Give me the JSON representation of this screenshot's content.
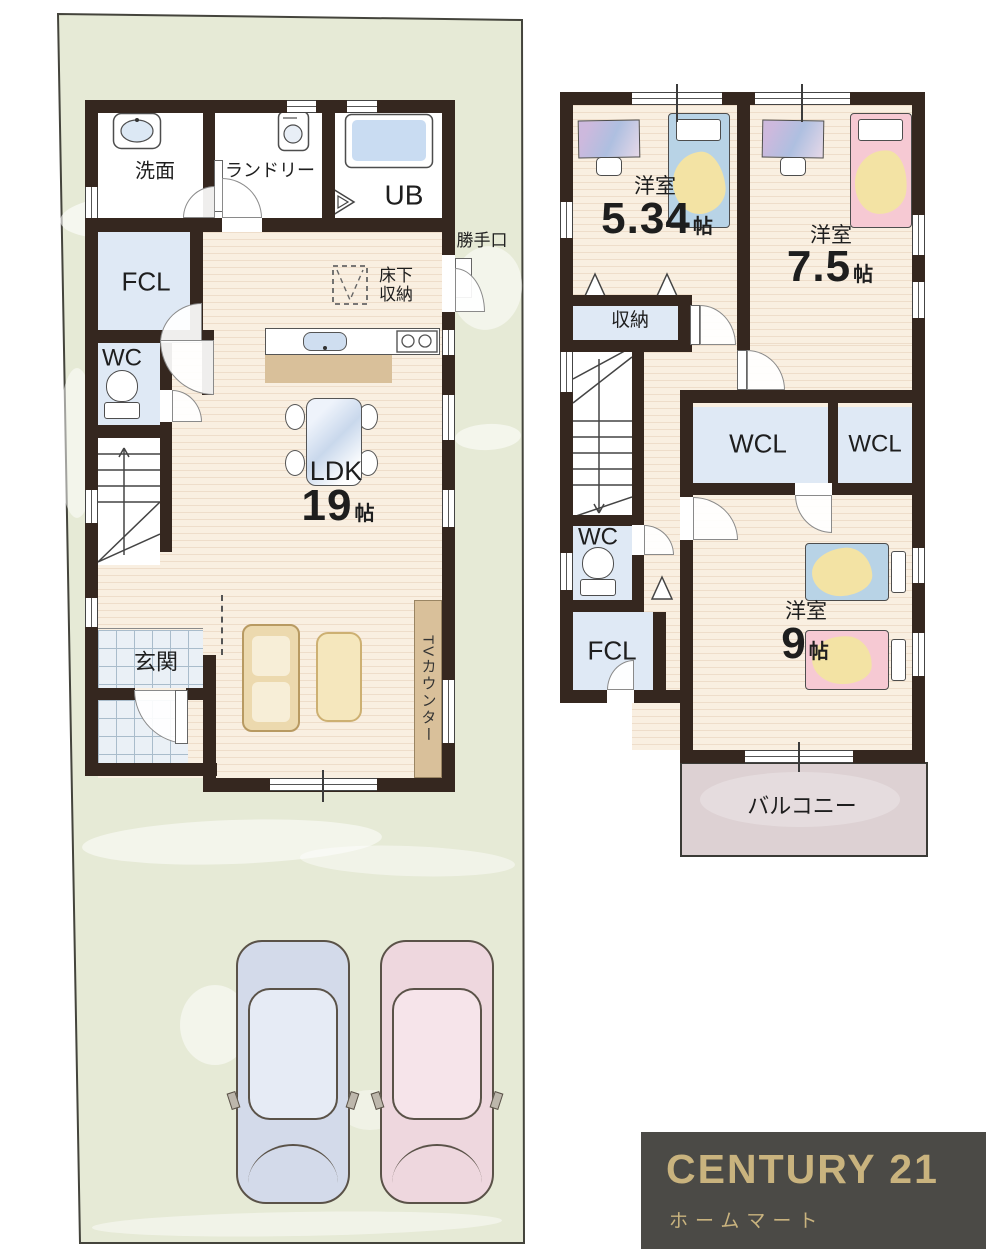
{
  "floor1": {
    "rooms": {
      "senmen": "洗面",
      "laundry": "ランドリー",
      "ub": "UB",
      "fcl": "FCL",
      "wc": "WC",
      "genkan": "玄関",
      "ldk": {
        "name": "LDK",
        "size": "19",
        "unit": "帖"
      }
    },
    "annotations": {
      "katteguchi": "勝手口",
      "yukashita_line1": "床下",
      "yukashita_line2": "収納",
      "tv_counter": "TVカウンター"
    }
  },
  "floor2": {
    "rooms": {
      "bed1": {
        "name": "洋室",
        "size": "5.34",
        "unit": "帖"
      },
      "bed2": {
        "name": "洋室",
        "size": "7.5",
        "unit": "帖"
      },
      "bed3": {
        "name": "洋室",
        "size": "9",
        "unit": "帖"
      },
      "shuno": "収納",
      "wcl_left": "WCL",
      "wcl_right": "WCL",
      "wc": "WC",
      "fcl": "FCL",
      "balcony": "バルコニー"
    }
  },
  "logo": {
    "brand": "CENTURY 21",
    "subtitle": "ホームマート"
  },
  "colors": {
    "wall": "#35271f",
    "lot_green": "#e6ead6",
    "wood_floor": "#f9efe1",
    "room_blue": "#dfe9f5",
    "balcony_pink": "#ddd1d3",
    "counter_tan": "#d9c09a",
    "logo_bg": "#4b4a46",
    "logo_gold": "#c9b37e",
    "bed_blue": "#b8d3e6",
    "bed_pink": "#f6c9d3",
    "blanket_yellow": "#f3e3a4",
    "car_blue": "#d3daea",
    "car_pink": "#eed7de"
  }
}
